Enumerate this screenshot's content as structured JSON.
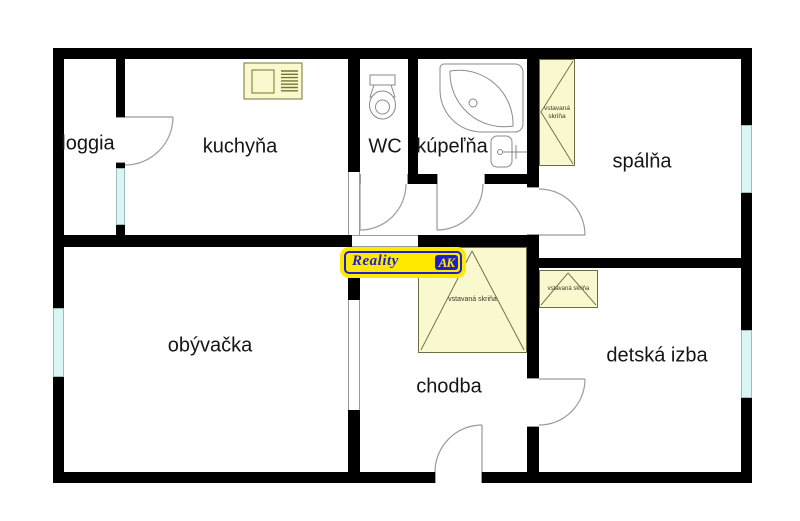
{
  "rooms": [
    {
      "id": "loggia",
      "label": "loggia"
    },
    {
      "id": "kuchyna",
      "label": "kuchyňa"
    },
    {
      "id": "wc",
      "label": "WC"
    },
    {
      "id": "kupelna",
      "label": "kúpeľňa"
    },
    {
      "id": "spalna",
      "label": "spálňa"
    },
    {
      "id": "obyvacka",
      "label": "obývačka"
    },
    {
      "id": "chodba",
      "label": "chodba"
    },
    {
      "id": "detska",
      "label": "detská izba"
    }
  ],
  "wardrobe": {
    "label": "vstavaná skriňa"
  },
  "logo": {
    "name": "Reality",
    "monogram": "AK",
    "yellow": "#ffe900",
    "blue": "#1f1fc8"
  },
  "colors": {
    "wall": "#000000",
    "window": "#d9f6f4",
    "wardrobe_fill": "#faf8cf",
    "wardrobe_border": "#6e6e46",
    "fixture_stroke": "#8a8a8a"
  },
  "fixtures": [
    "stove-icon",
    "toilet-icon",
    "bathtub-icon",
    "sink-icon"
  ]
}
